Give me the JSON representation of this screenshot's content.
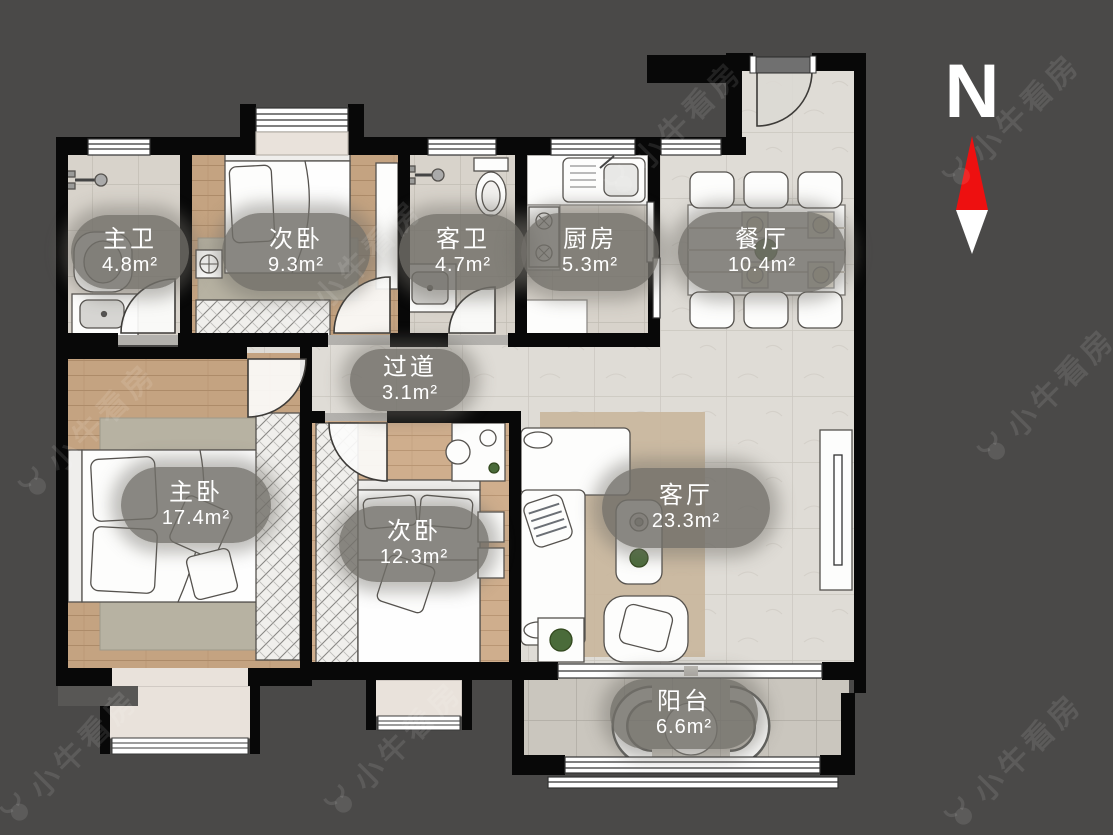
{
  "page": {
    "background": "#4a4948"
  },
  "floor_plan": {
    "wall_color": "#080808",
    "rooms": [
      {
        "id": "master-bath",
        "name": "主卫",
        "area": "4.8m²",
        "floor": "tile"
      },
      {
        "id": "bedroom-north",
        "name": "次卧",
        "area": "9.3m²",
        "floor": "wood"
      },
      {
        "id": "guest-bath",
        "name": "客卫",
        "area": "4.7m²",
        "floor": "tile"
      },
      {
        "id": "kitchen",
        "name": "厨房",
        "area": "5.3m²",
        "floor": "tile"
      },
      {
        "id": "dining-room",
        "name": "餐厅",
        "area": "10.4m²",
        "floor": "tile"
      },
      {
        "id": "hallway",
        "name": "过道",
        "area": "3.1m²",
        "floor": "tile"
      },
      {
        "id": "master-bedroom",
        "name": "主卧",
        "area": "17.4m²",
        "floor": "wood"
      },
      {
        "id": "bedroom-south",
        "name": "次卧",
        "area": "12.3m²",
        "floor": "wood"
      },
      {
        "id": "living-room",
        "name": "客厅",
        "area": "23.3m²",
        "floor": "tile"
      },
      {
        "id": "balcony",
        "name": "阳台",
        "area": "6.6m²",
        "floor": "tile"
      }
    ]
  },
  "compass": {
    "label": "N",
    "north_color": "#ee1010",
    "south_color": "#ffffff"
  },
  "watermark": {
    "text": "小牛看房"
  }
}
